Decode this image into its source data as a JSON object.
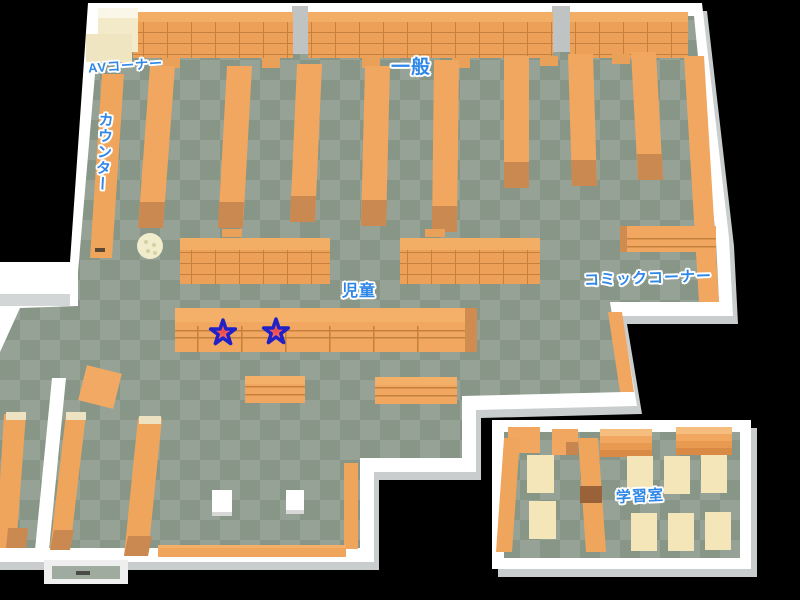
{
  "map": {
    "type": "library-floor-map",
    "areas": [
      {
        "id": "av-corner",
        "label": "AVコーナー"
      },
      {
        "id": "general",
        "label": "一般"
      },
      {
        "id": "counter",
        "label": "カウンター"
      },
      {
        "id": "children",
        "label": "児童"
      },
      {
        "id": "comic-corner",
        "label": "コミックコーナー"
      },
      {
        "id": "study-room",
        "label": "学習室"
      }
    ],
    "markers": [
      {
        "id": "star-1",
        "type": "star"
      },
      {
        "id": "star-2",
        "type": "star"
      }
    ],
    "colors": {
      "background": "#000000",
      "floor_light": "#95A295",
      "floor_dark": "#879687",
      "wall": "#FFFFFF",
      "wall_shadow": "#C9CDCD",
      "shelf": "#F1A75F",
      "shelf_cap": "#C98950",
      "shelf_line": "#C5803E",
      "table": "#F4E6B9",
      "av_unit": "#F3EAC9",
      "label_text": "#2F87E8",
      "star_fill": "#F56B6B",
      "star_outline": "#2121C8"
    }
  }
}
